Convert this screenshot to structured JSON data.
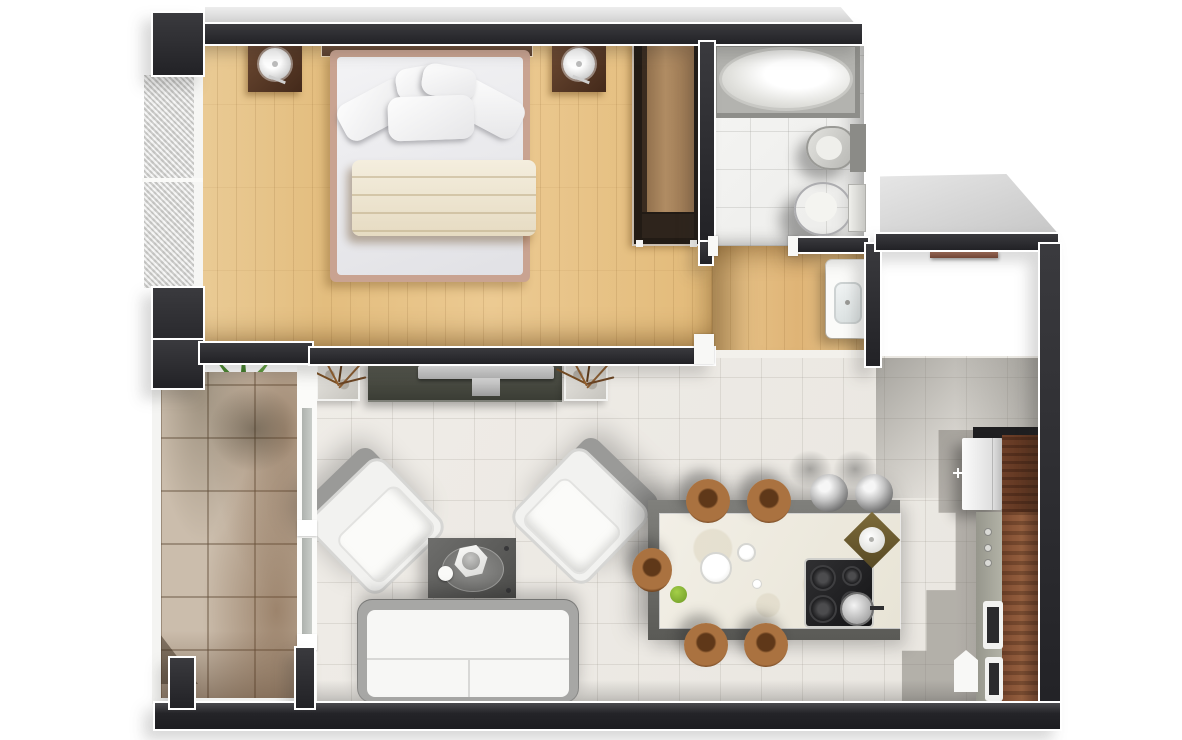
{
  "scene": {
    "kind": "3d-rendered-apartment-floor-plan-top-view",
    "canvas": {
      "width": 1182,
      "height": 740
    }
  },
  "palette": {
    "wall_dark": "#2a2a2e",
    "outline_white": "#ffffff",
    "bedroom_wood_floor": "#e5c28b",
    "hall_wood_floor": "#e0ba80",
    "living_tile_floor": "#edeae5",
    "bathroom_tile_floor": "#f3f3f1",
    "balcony_tile_floor": "#cbbdac",
    "entry_slab_gray": "#d7d7d7",
    "walnut_cabinet": "#7a4a30",
    "island_marble": "#f0ece1",
    "stool_leather_brown": "#a06a3e",
    "metal_silver": "#b9b9b9",
    "sofa_white": "#f6f6f4",
    "plant_green": "#4f8a2f",
    "blanket_cream": "#eee6d2",
    "bed_frame_tan": "#c9a391",
    "tv_console_green_gray": "#474b44"
  },
  "rooms": [
    {
      "id": "bedroom",
      "floor": "wood-plank"
    },
    {
      "id": "bathroom",
      "floor": "white-tile"
    },
    {
      "id": "hallway",
      "floor": "wood-plank"
    },
    {
      "id": "living-dining-room",
      "floor": "white-tile"
    },
    {
      "id": "kitchen",
      "floor": "white-tile"
    },
    {
      "id": "balcony",
      "floor": "stone-tile"
    },
    {
      "id": "entry-landing",
      "floor": "concrete-slab"
    }
  ],
  "furniture": {
    "bedroom": [
      "double-bed",
      "wood-headboard",
      "pillows-x5",
      "folded-cream-blanket",
      "nightstand-left",
      "nightstand-right",
      "round-table-lamp-x2",
      "wardrobe-with-open-shelf"
    ],
    "bathroom": [
      "bathtub-in-recess",
      "bidet",
      "toilet-with-tank"
    ],
    "hallway": [
      "washbasin-vanity"
    ],
    "living_room": [
      "tv-sideboard",
      "flat-tv",
      "twig-planter-x2",
      "white-armchair-x2",
      "dark-coffee-table",
      "round-tray-with-decor-bowl-and-jug",
      "white-two-seat-sofa",
      "brown-wall-shelf"
    ],
    "kitchen": [
      "island-counter-marble-top",
      "cooktop-4-burner",
      "steel-pot",
      "cutting-board-with-bowl",
      "plates-and-greens",
      "leather-bar-stool-x5",
      "steel-sphere-stool-x2",
      "fridge",
      "tall-walnut-cabinet",
      "gray-worktop-with-knobs",
      "walnut-counter",
      "built-in-oven-x2",
      "white-small-appliance"
    ],
    "balcony": [
      "potted-palm-plant-two-crowns"
    ]
  },
  "window_and_doors": [
    "frosted-glass-window-left-x2",
    "balcony-glass-divider-two-panes",
    "bedroom-door-opening",
    "bathroom-door-opening",
    "hall-to-living-threshold"
  ]
}
